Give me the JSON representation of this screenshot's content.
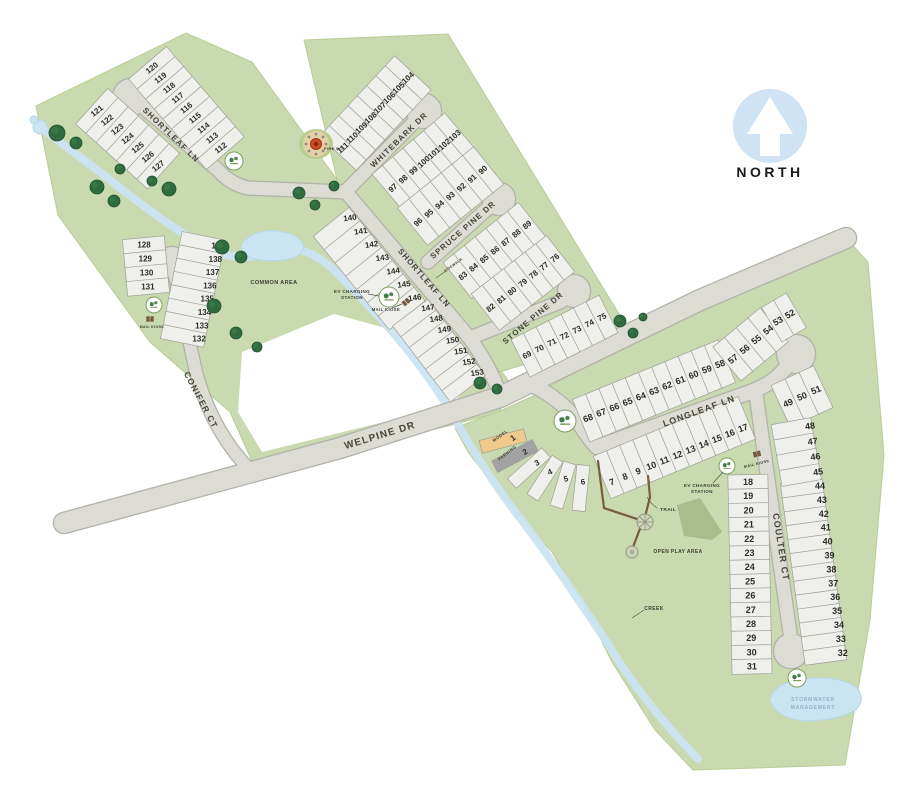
{
  "north": {
    "label": "NORTH"
  },
  "streets": [
    "SHORTLEAF LN",
    "WHITEBARK DR",
    "SPRUCE PINE DR",
    "STONE PINE DR",
    "CONIFER CT",
    "WELPINE DR",
    "LONGLEAF LN",
    "COULTER CT"
  ],
  "amenities": {
    "common_area": "COMMON AREA",
    "fire_pit": "FIRE PIT",
    "ev_charging_line1": "EV CHARGING",
    "ev_charging_line2": "STATION",
    "mail_kiosk": "MAIL KIOSK",
    "model": "MODEL",
    "parking": "PARKING",
    "trail": "TRAIL",
    "open_play_area": "OPEN PLAY AREA",
    "creek": "CREEK",
    "sidewalk": "SIDEWALK",
    "stormwater_line1": "STORMWATER",
    "stormwater_line2": "MANAGEMENT"
  },
  "lots": {
    "groups": [
      {
        "id": "shortleaf-upper-east",
        "lots": [
          120,
          119,
          118,
          117,
          116,
          115,
          114,
          113,
          112
        ]
      },
      {
        "id": "shortleaf-upper-west",
        "lots": [
          121,
          122,
          123,
          124,
          125,
          126,
          127
        ]
      },
      {
        "id": "whitebark-west",
        "lots": [
          104,
          105,
          106,
          107,
          108,
          109,
          110,
          111
        ]
      },
      {
        "id": "whitebark-east",
        "lots": [
          97,
          98,
          99,
          100,
          101,
          102,
          103
        ]
      },
      {
        "id": "spruce-west",
        "lots": [
          90,
          91,
          92,
          93,
          94,
          95,
          96
        ]
      },
      {
        "id": "spruce-east",
        "lots": [
          83,
          84,
          85,
          86,
          87,
          88,
          89
        ]
      },
      {
        "id": "stone-north",
        "lots": [
          76,
          77,
          78,
          79,
          80,
          81,
          82
        ]
      },
      {
        "id": "stone-south",
        "lots": [
          69,
          70,
          71,
          72,
          73,
          74,
          75
        ]
      },
      {
        "id": "shortleaf-lower-west-a",
        "lots": [
          140,
          141,
          142,
          143,
          144,
          145,
          146
        ]
      },
      {
        "id": "shortleaf-lower-west-b",
        "lots": [
          147,
          148,
          149,
          150,
          151,
          152,
          153
        ]
      },
      {
        "id": "conifer-west",
        "lots": [
          128,
          129,
          130,
          131
        ]
      },
      {
        "id": "conifer-east",
        "lots": [
          139,
          138,
          137,
          136,
          135,
          134,
          133,
          132
        ]
      },
      {
        "id": "welpine-fan",
        "lots": [
          1,
          2,
          3,
          4,
          5,
          6
        ]
      },
      {
        "id": "longleaf-south",
        "lots": [
          7,
          8,
          9,
          10,
          11,
          12,
          13,
          14,
          15,
          16,
          17
        ]
      },
      {
        "id": "longleaf-north",
        "lots": [
          68,
          67,
          66,
          65,
          64,
          63,
          62,
          61,
          60,
          59,
          58
        ]
      },
      {
        "id": "longleaf-nw",
        "lots": [
          57,
          56,
          55,
          54
        ]
      },
      {
        "id": "longleaf-top",
        "lots": [
          53,
          52
        ]
      },
      {
        "id": "longleaf-east",
        "lots": [
          49,
          50,
          51
        ]
      },
      {
        "id": "coulter-west",
        "lots": [
          18,
          19,
          20,
          21,
          22,
          23,
          24,
          25,
          26,
          27,
          28,
          29,
          30,
          31
        ]
      },
      {
        "id": "coulter-east",
        "lots": [
          44,
          43,
          42,
          41,
          40,
          39,
          38,
          37,
          36,
          35,
          34,
          33,
          32
        ]
      },
      {
        "id": "coulter-east-upper",
        "lots": [
          48,
          47,
          46,
          45
        ]
      }
    ]
  },
  "colors": {
    "parcel_green": "#c9dab0",
    "parcel_edge": "#b9cc97",
    "road_fill": "#dcdcd4",
    "road_edge": "#b2b2aa",
    "lot_fill": "#efefeb",
    "lot_stroke": "#a0a099",
    "water": "#cbe4f2",
    "water_edge": "#b5d7e8",
    "tree": "#2f6b3f",
    "tree_dark": "#245232",
    "trail": "#7a5c3a",
    "open_play": "#a9bc8b",
    "north_blue": "#cfe3f4",
    "model_tan": "#f0c98c",
    "parking_gray": "#a2a2a2",
    "label_dark": "#3c3c34",
    "street_label": "#45453b",
    "number_dark": "#2d2d28",
    "stormwater_text": "#90b5cb",
    "monument_green": "#7ba05b",
    "firepit_red": "#cc4a28"
  }
}
